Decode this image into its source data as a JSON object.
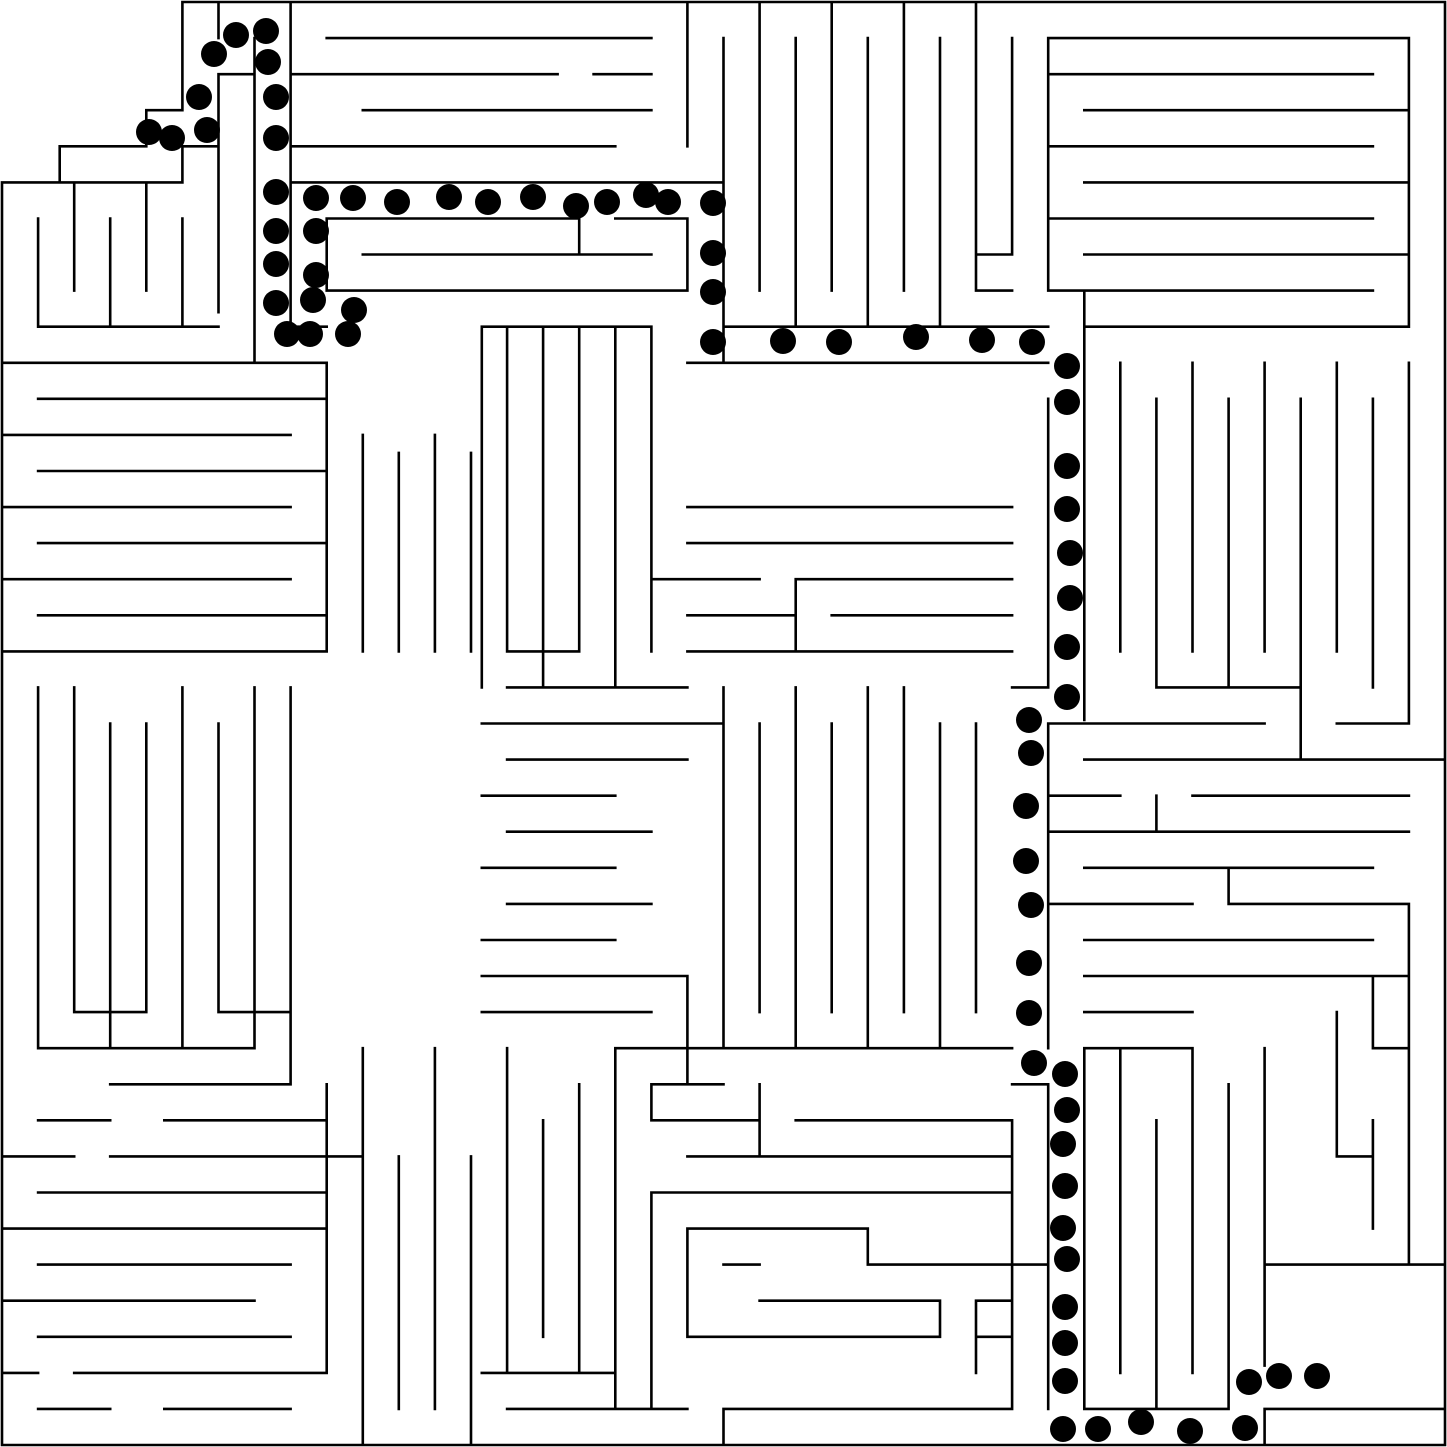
{
  "canvas": {
    "width": 1447,
    "height": 1447,
    "background_color": "#ffffff"
  },
  "maze": {
    "description": "orthogonal maze with drawn solution path of black dots",
    "grid_cols": 40,
    "grid_rows": 40,
    "cell_size": 36.075,
    "origin_px": 2,
    "wall_color": "#000000",
    "wall_width": 2.6,
    "entrance": "top-left notch",
    "goal": "open room bottom-right",
    "walls_grid_units": [
      [
        5,
        0,
        40,
        0
      ],
      [
        40,
        0,
        40,
        40
      ],
      [
        0,
        40,
        40,
        40
      ],
      [
        0,
        5,
        0,
        40
      ],
      [
        5,
        0,
        5,
        3
      ],
      [
        4,
        3,
        5,
        3
      ],
      [
        4,
        3,
        4,
        4
      ],
      [
        1.6,
        4,
        4,
        4
      ],
      [
        1.6,
        4,
        1.6,
        5
      ],
      [
        0,
        5,
        5,
        5
      ],
      [
        5,
        4,
        5,
        5
      ],
      [
        5,
        4,
        6,
        4
      ],
      [
        6,
        0,
        6,
        1
      ],
      [
        6,
        2,
        7,
        2
      ],
      [
        6,
        2,
        6,
        8.6
      ],
      [
        7,
        1,
        7,
        10
      ],
      [
        8,
        0,
        8,
        9
      ],
      [
        8,
        9,
        9,
        9
      ],
      [
        9,
        1,
        18,
        1
      ],
      [
        8,
        2,
        15.4,
        2
      ],
      [
        16.4,
        2,
        18,
        2
      ],
      [
        10,
        3,
        18,
        3
      ],
      [
        8,
        4,
        17,
        4
      ],
      [
        19,
        0,
        19,
        4
      ],
      [
        8,
        5,
        20,
        5
      ],
      [
        9,
        6,
        16,
        6
      ],
      [
        16,
        6,
        16,
        7
      ],
      [
        17,
        6,
        19,
        6
      ],
      [
        10,
        7,
        18,
        7
      ],
      [
        9,
        8,
        19,
        8
      ],
      [
        9,
        6,
        9,
        8
      ],
      [
        19,
        6,
        19,
        8
      ],
      [
        20,
        5,
        20,
        10
      ],
      [
        1,
        6,
        1,
        9
      ],
      [
        2,
        5,
        2,
        8
      ],
      [
        3,
        6,
        3,
        9
      ],
      [
        4,
        5,
        4,
        8
      ],
      [
        5,
        6,
        5,
        9
      ],
      [
        1,
        9,
        6,
        9
      ],
      [
        0,
        10,
        9,
        10
      ],
      [
        1,
        11,
        9,
        11
      ],
      [
        0,
        12,
        8,
        12
      ],
      [
        1,
        13,
        9,
        13
      ],
      [
        0,
        14,
        8,
        14
      ],
      [
        1,
        15,
        9,
        15
      ],
      [
        0,
        16,
        8,
        16
      ],
      [
        1,
        17,
        9,
        17
      ],
      [
        0,
        18,
        9,
        18
      ],
      [
        9,
        10,
        9,
        18
      ],
      [
        10,
        12,
        10,
        18
      ],
      [
        11,
        12.5,
        11,
        18
      ],
      [
        12,
        12,
        12,
        18
      ],
      [
        13,
        12.5,
        13,
        18
      ],
      [
        1,
        19,
        1,
        29
      ],
      [
        2,
        19,
        2,
        28
      ],
      [
        3,
        20,
        3,
        29
      ],
      [
        4,
        20,
        4,
        28
      ],
      [
        5,
        19,
        5,
        29
      ],
      [
        6,
        20,
        6,
        28
      ],
      [
        7,
        19,
        7,
        29
      ],
      [
        8,
        19,
        8,
        30
      ],
      [
        2,
        28,
        4,
        28
      ],
      [
        6,
        28,
        8,
        28
      ],
      [
        1,
        29,
        7,
        29
      ],
      [
        13.3,
        9,
        18,
        9
      ],
      [
        13.3,
        9,
        13.3,
        19
      ],
      [
        14,
        9,
        14,
        18
      ],
      [
        15,
        9,
        15,
        19
      ],
      [
        16,
        9,
        16,
        18
      ],
      [
        17,
        9,
        17,
        19
      ],
      [
        18,
        9,
        18,
        18
      ],
      [
        14,
        18,
        16,
        18
      ],
      [
        14,
        19,
        19,
        19
      ],
      [
        20,
        1,
        20,
        9
      ],
      [
        21,
        0,
        21,
        8
      ],
      [
        22,
        1,
        22,
        9
      ],
      [
        23,
        0,
        23,
        8
      ],
      [
        24,
        1,
        24,
        9
      ],
      [
        25,
        0,
        25,
        8
      ],
      [
        26,
        1,
        26,
        9
      ],
      [
        27,
        0,
        27,
        8
      ],
      [
        20,
        9,
        29,
        9
      ],
      [
        19,
        10,
        29,
        10
      ],
      [
        28,
        1,
        28,
        7
      ],
      [
        27,
        7,
        28,
        7
      ],
      [
        29,
        1,
        39,
        1
      ],
      [
        29,
        1,
        29,
        8
      ],
      [
        39,
        1,
        39,
        9
      ],
      [
        29,
        2,
        38,
        2
      ],
      [
        30,
        3,
        39,
        3
      ],
      [
        29,
        4,
        38,
        4
      ],
      [
        30,
        5,
        39,
        5
      ],
      [
        29,
        6,
        38,
        6
      ],
      [
        30,
        7,
        39,
        7
      ],
      [
        29,
        8,
        38,
        8
      ],
      [
        27,
        8,
        28,
        8
      ],
      [
        30,
        9,
        39,
        9
      ],
      [
        30,
        8,
        30,
        19.9
      ],
      [
        31,
        10,
        31,
        18
      ],
      [
        32,
        11,
        32,
        19
      ],
      [
        33,
        10,
        33,
        18
      ],
      [
        34,
        11,
        34,
        19
      ],
      [
        35,
        10,
        35,
        18
      ],
      [
        36,
        11,
        36,
        19
      ],
      [
        37,
        10,
        37,
        18
      ],
      [
        38,
        11,
        38,
        19
      ],
      [
        39,
        10,
        39,
        20
      ],
      [
        32,
        19,
        36,
        19
      ],
      [
        29,
        11,
        29,
        19
      ],
      [
        29,
        20,
        29,
        29
      ],
      [
        28,
        19,
        29,
        19
      ],
      [
        29,
        20,
        35,
        20
      ],
      [
        36,
        19,
        36,
        21
      ],
      [
        37,
        20,
        39,
        20
      ],
      [
        30,
        21,
        40,
        21
      ],
      [
        29,
        22,
        31,
        22
      ],
      [
        33,
        22,
        39,
        22
      ],
      [
        32,
        22,
        32,
        23
      ],
      [
        29,
        23,
        39,
        23
      ],
      [
        30,
        24,
        38,
        24
      ],
      [
        29,
        25,
        33,
        25
      ],
      [
        34,
        24,
        34,
        25
      ],
      [
        34,
        25,
        39,
        25
      ],
      [
        30,
        26,
        38,
        26
      ],
      [
        30,
        27,
        39,
        27
      ],
      [
        19,
        14,
        28,
        14
      ],
      [
        19,
        15,
        28,
        15
      ],
      [
        18,
        16,
        21,
        16
      ],
      [
        22,
        16,
        28,
        16
      ],
      [
        22,
        16,
        22,
        18
      ],
      [
        19,
        17,
        22,
        17
      ],
      [
        23,
        17,
        28,
        17
      ],
      [
        19,
        18,
        28,
        18
      ],
      [
        13.3,
        20,
        20,
        20
      ],
      [
        14,
        21,
        19,
        21
      ],
      [
        13.3,
        22,
        17,
        22
      ],
      [
        14,
        23,
        18,
        23
      ],
      [
        13.3,
        24,
        17,
        24
      ],
      [
        14,
        25,
        18,
        25
      ],
      [
        13.3,
        26,
        17,
        26
      ],
      [
        13.3,
        27,
        19,
        27
      ],
      [
        13.3,
        28,
        18,
        28
      ],
      [
        20,
        19,
        20,
        29
      ],
      [
        21,
        20,
        21,
        28
      ],
      [
        22,
        19,
        22,
        29
      ],
      [
        23,
        20,
        23,
        28
      ],
      [
        24,
        19,
        24,
        29
      ],
      [
        25,
        19,
        25,
        28
      ],
      [
        26,
        20,
        26,
        29
      ],
      [
        27,
        20,
        27,
        28
      ],
      [
        17,
        29,
        19,
        29
      ],
      [
        19,
        27,
        19,
        30
      ],
      [
        19,
        29,
        28,
        29
      ],
      [
        14,
        29,
        14,
        38
      ],
      [
        15,
        31,
        15,
        37
      ],
      [
        16,
        30,
        16,
        38
      ],
      [
        17,
        29,
        17,
        39
      ],
      [
        18,
        30,
        18,
        31
      ],
      [
        18,
        33,
        18,
        39
      ],
      [
        13.3,
        38,
        17,
        38
      ],
      [
        14,
        39,
        19,
        39
      ],
      [
        20,
        39,
        28,
        39
      ],
      [
        20,
        39,
        20,
        40
      ],
      [
        18,
        30,
        20,
        30
      ],
      [
        28,
        30,
        29,
        30
      ],
      [
        18,
        31,
        21,
        31
      ],
      [
        22,
        31,
        28,
        31
      ],
      [
        21,
        30,
        21,
        32
      ],
      [
        19,
        32,
        28,
        32
      ],
      [
        18,
        33,
        28,
        33
      ],
      [
        19,
        34,
        24,
        34
      ],
      [
        24,
        34,
        24,
        35
      ],
      [
        19,
        34,
        19,
        37
      ],
      [
        20,
        35,
        21,
        35
      ],
      [
        24,
        35,
        27,
        35
      ],
      [
        27,
        35,
        29,
        35
      ],
      [
        21,
        36,
        26,
        36
      ],
      [
        27,
        36,
        28,
        36
      ],
      [
        26,
        36,
        26,
        37
      ],
      [
        19,
        37,
        26,
        37
      ],
      [
        27,
        37,
        28,
        37
      ],
      [
        27,
        36,
        27,
        38
      ],
      [
        3,
        30,
        8,
        30
      ],
      [
        1,
        31,
        3,
        31
      ],
      [
        4.5,
        31,
        9,
        31
      ],
      [
        0,
        32,
        2,
        32
      ],
      [
        3,
        32,
        10,
        32
      ],
      [
        1,
        33,
        9,
        33
      ],
      [
        0,
        34,
        9,
        34
      ],
      [
        1,
        35,
        8,
        35
      ],
      [
        0,
        36,
        7,
        36
      ],
      [
        1,
        37,
        8,
        37
      ],
      [
        0,
        38,
        1,
        38
      ],
      [
        2,
        38,
        9,
        38
      ],
      [
        1,
        39,
        3,
        39
      ],
      [
        4.5,
        39,
        8,
        39
      ],
      [
        9,
        30,
        9,
        38
      ],
      [
        10,
        29,
        10,
        40
      ],
      [
        11,
        32,
        11,
        39
      ],
      [
        12,
        29,
        12,
        39
      ],
      [
        13,
        32,
        13,
        40
      ],
      [
        29,
        30,
        29,
        39
      ],
      [
        30,
        29,
        30,
        39
      ],
      [
        31,
        29,
        31,
        38
      ],
      [
        32,
        31,
        32,
        39
      ],
      [
        33,
        29,
        33,
        38
      ],
      [
        34,
        30,
        34,
        39
      ],
      [
        35,
        29,
        35,
        35
      ],
      [
        30,
        29,
        33,
        29
      ],
      [
        28,
        31,
        28,
        39
      ],
      [
        30,
        39,
        34,
        39
      ],
      [
        35,
        39,
        40,
        39
      ],
      [
        35,
        35,
        35,
        37.8
      ],
      [
        35,
        39,
        35,
        40
      ],
      [
        35,
        35,
        40,
        35
      ],
      [
        30,
        28,
        33,
        28
      ],
      [
        37,
        28,
        37,
        32
      ],
      [
        38,
        27,
        38,
        29
      ],
      [
        38,
        31,
        38,
        34
      ],
      [
        37,
        32,
        38,
        32
      ],
      [
        38,
        29,
        39,
        29
      ],
      [
        39,
        25,
        39,
        35
      ]
    ]
  },
  "solution": {
    "dot_color": "#000000",
    "dot_radius_px": 13,
    "start_point_px": [
      149,
      132
    ],
    "end_point_px": [
      1317,
      1376
    ],
    "dots_px": [
      [
        149,
        132
      ],
      [
        172,
        138
      ],
      [
        207,
        130
      ],
      [
        199,
        97
      ],
      [
        214,
        54
      ],
      [
        236,
        35
      ],
      [
        266,
        31
      ],
      [
        268,
        62
      ],
      [
        276,
        97
      ],
      [
        276,
        138
      ],
      [
        276,
        192
      ],
      [
        276,
        231
      ],
      [
        276,
        264
      ],
      [
        276,
        303
      ],
      [
        287,
        334
      ],
      [
        310,
        334
      ],
      [
        348,
        334
      ],
      [
        354,
        310
      ],
      [
        313,
        300
      ],
      [
        316,
        275
      ],
      [
        316,
        231
      ],
      [
        316,
        198
      ],
      [
        353,
        198
      ],
      [
        397,
        202
      ],
      [
        449,
        197
      ],
      [
        488,
        202
      ],
      [
        533,
        197
      ],
      [
        576,
        206
      ],
      [
        607,
        202
      ],
      [
        646,
        195
      ],
      [
        668,
        202
      ],
      [
        713,
        203
      ],
      [
        713,
        253
      ],
      [
        713,
        292
      ],
      [
        713,
        342
      ],
      [
        783,
        341
      ],
      [
        839,
        342
      ],
      [
        916,
        337
      ],
      [
        982,
        340
      ],
      [
        1032,
        342
      ],
      [
        1067,
        366
      ],
      [
        1067,
        402
      ],
      [
        1067,
        466
      ],
      [
        1067,
        509
      ],
      [
        1070,
        553
      ],
      [
        1070,
        598
      ],
      [
        1067,
        647
      ],
      [
        1067,
        697
      ],
      [
        1029,
        720
      ],
      [
        1031,
        753
      ],
      [
        1026,
        806
      ],
      [
        1026,
        861
      ],
      [
        1031,
        905
      ],
      [
        1029,
        963
      ],
      [
        1029,
        1013
      ],
      [
        1034,
        1063
      ],
      [
        1065,
        1074
      ],
      [
        1067,
        1110
      ],
      [
        1063,
        1144
      ],
      [
        1065,
        1186
      ],
      [
        1063,
        1228
      ],
      [
        1067,
        1259
      ],
      [
        1065,
        1307
      ],
      [
        1065,
        1343
      ],
      [
        1065,
        1381
      ],
      [
        1063,
        1429
      ],
      [
        1098,
        1429
      ],
      [
        1141,
        1422
      ],
      [
        1190,
        1431
      ],
      [
        1245,
        1428
      ],
      [
        1249,
        1382
      ],
      [
        1279,
        1376
      ],
      [
        1317,
        1376
      ]
    ]
  }
}
